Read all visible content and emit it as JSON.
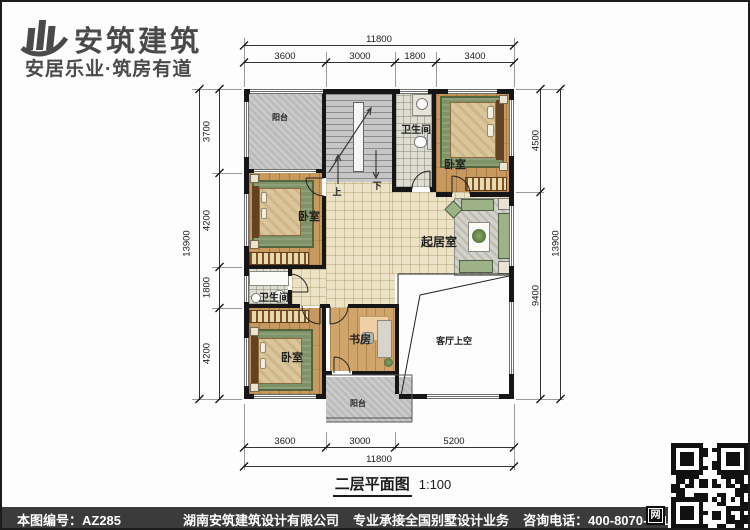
{
  "brand": {
    "name": "安筑建筑",
    "tagline": "安居乐业·筑房有道"
  },
  "watermark": {
    "text": "安筑建筑",
    "site": "hnazjz.com"
  },
  "plan": {
    "rooms": {
      "balcony_top": "阳台",
      "bath_top": "卫生间",
      "bedroom_tr": "卧室",
      "bedroom_ml": "卧室",
      "bath_ml": "卫生间",
      "living": "起居室",
      "void": "客厅上空",
      "bedroom_bl": "卧室",
      "study": "书房",
      "balcony_bottom": "阳台"
    },
    "stairs": {
      "up": "上",
      "down": "下"
    }
  },
  "dims": {
    "top": {
      "total": "11800",
      "segments": [
        "3600",
        "3000",
        "1800",
        "3400"
      ]
    },
    "left": {
      "total": "13900",
      "segments": [
        "3700",
        "4200",
        "1800",
        "4200"
      ]
    },
    "right": {
      "total": "13900",
      "segments": [
        "4500",
        "9400"
      ]
    },
    "bottom": {
      "total": "11800",
      "segments": [
        "3600",
        "3000",
        "5200"
      ]
    }
  },
  "caption": {
    "title": "二层平面图",
    "scale": "1:100"
  },
  "footer": {
    "drawing_no": "本图编号：AZ285",
    "company": "湖南安筑建筑设计有限公司",
    "service": "专业承接全国别墅设计业务",
    "phone": "咨询电话：400-8070-511",
    "logo_char": "网"
  },
  "colors": {
    "wall": "#161616",
    "wood": "#c8995f",
    "tile": "#ece3c6",
    "concrete": "#bcbcbc",
    "footer_bg": "#3b3b3b",
    "sofa_green": "#9db287"
  }
}
